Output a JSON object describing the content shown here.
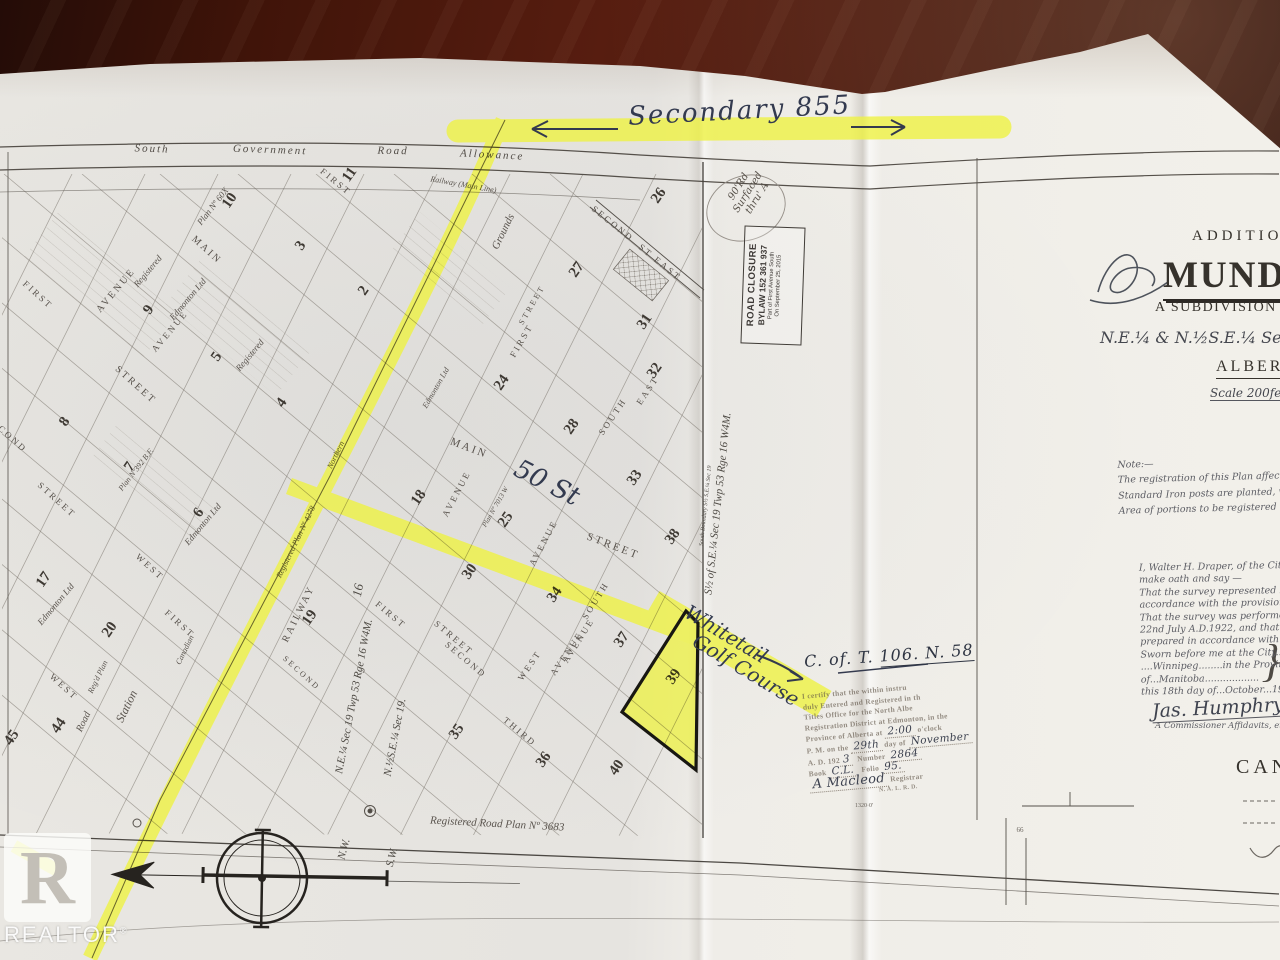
{
  "annotations": {
    "secondary": "Secondary  855",
    "fifty_st": "50 St",
    "whitetail_1": "Whitetail",
    "whitetail_2": "Golf Course",
    "cot_prefix": "C. of. T. ",
    "cot_number": "106. N. 58",
    "circle_note_1": "90'Rd",
    "circle_note_2": "Surfaced",
    "circle_note_3": "thru' A"
  },
  "title_block": {
    "addition": "ADDITION",
    "name": "MUNDA",
    "subdivision": "A SUBDIVISION OF PA",
    "legal": "N.E.¼ & N.½S.E.¼ Sec 19. Tw",
    "province": "ALBERTA",
    "scale": "Scale 200feet"
  },
  "note_block": {
    "heading": "Note:—",
    "lines": [
      "The registration of this Plan affects only th",
      "Standard Iron posts are planted, where sh",
      "Area of portions to be registered = 71·4"
    ]
  },
  "affidavit": {
    "lines": [
      "I, Walter H. Draper, of the City of Win",
      "make oath and say —",
      "That the survey represented by this p",
      "accordance with the provisions of the",
      "That the survey was performed bet",
      "22nd July A.D.1922, and that this pl",
      "prepared in accordance with the p",
      "Sworn before me at the City....of",
      "....Winnipeg........in the Province",
      "of...Manitoba..................",
      "this 18th day of...October...1922"
    ],
    "signature": "Jas. Humphry",
    "commissioner": "A Commissioner Affidavits, etc.",
    "canada": "CANAD"
  },
  "registry_stamp": {
    "l1": "I certify that the within instru",
    "l2": "duly Entered and Registered in th",
    "l3": "Titles Office for the North Albe",
    "l4": "Registration District at Edmonton, in the",
    "l5a": "Province of Alberta at",
    "time": "2:00",
    "l5b": "o'clock",
    "l6a": "P. M. on the",
    "day": "29th",
    "l6b": "day of",
    "month": "November",
    "l7a": "A. D. 192",
    "year": "3",
    "l7b": "Number",
    "number": "2864",
    "l8a": "Book",
    "book": "C.L.",
    "l8b": "Folio",
    "folio": "95.",
    "signature": "A Macleod",
    "registrar": "Registrar",
    "district": "N. A. L. R. D."
  },
  "road_closure": {
    "l1": "ROAD CLOSURE",
    "l2": "BYLAW  152 361 937",
    "l3": "Part of First Avenue South",
    "l4": "On September 25, 2015"
  },
  "watermark": {
    "letter": "R",
    "brand": "REALTOR",
    "reg": "®"
  },
  "map": {
    "labels": [
      {
        "t": "MAIN",
        "x": 205,
        "y": 252,
        "r": 42,
        "s": 10,
        "c": "st"
      },
      {
        "t": "AVENUE",
        "x": 118,
        "y": 292,
        "r": -50,
        "s": 10,
        "c": "st"
      },
      {
        "t": "AVENUE",
        "x": 172,
        "y": 333,
        "r": -50,
        "s": 9,
        "c": "st"
      },
      {
        "t": "FIRST",
        "x": 36,
        "y": 297,
        "r": 42,
        "s": 9,
        "c": "st"
      },
      {
        "t": "STREET",
        "x": 134,
        "y": 387,
        "r": 42,
        "s": 10,
        "c": "st"
      },
      {
        "t": "SECOND",
        "x": 5,
        "y": 436,
        "r": 42,
        "s": 9,
        "c": "st"
      },
      {
        "t": "STREET",
        "x": 55,
        "y": 502,
        "r": 42,
        "s": 9,
        "c": "st"
      },
      {
        "t": "WEST",
        "x": 148,
        "y": 569,
        "r": 42,
        "s": 9,
        "c": "st"
      },
      {
        "t": "FIRST",
        "x": 178,
        "y": 626,
        "r": 42,
        "s": 9,
        "c": "st"
      },
      {
        "t": "WEST",
        "x": 62,
        "y": 689,
        "r": 42,
        "s": 9,
        "c": "st"
      },
      {
        "t": "MAIN",
        "x": 468,
        "y": 451,
        "r": 21,
        "s": 11,
        "c": "st",
        "ls": 4
      },
      {
        "t": "STREET",
        "x": 612,
        "y": 549,
        "r": 21,
        "s": 11,
        "c": "st",
        "ls": 4
      },
      {
        "t": "FIRST",
        "x": 389,
        "y": 617,
        "r": 40,
        "s": 9,
        "c": "st"
      },
      {
        "t": "STREET",
        "x": 452,
        "y": 640,
        "r": 40,
        "s": 9,
        "c": "st"
      },
      {
        "t": "SECOND",
        "x": 464,
        "y": 662,
        "r": 40,
        "s": 9,
        "c": "st"
      },
      {
        "t": "THIRD",
        "x": 518,
        "y": 734,
        "r": 40,
        "s": 9,
        "c": "st"
      },
      {
        "t": "WEST",
        "x": 532,
        "y": 667,
        "r": -56,
        "s": 9,
        "c": "st"
      },
      {
        "t": "AVENUE",
        "x": 569,
        "y": 655,
        "r": -56,
        "s": 9,
        "c": "st"
      },
      {
        "t": "AVENUE",
        "x": 459,
        "y": 495,
        "r": -62,
        "s": 9,
        "c": "st"
      },
      {
        "t": "AVENUE",
        "x": 546,
        "y": 544,
        "r": -62,
        "s": 9,
        "c": "st"
      },
      {
        "t": "SOUTH",
        "x": 615,
        "y": 418,
        "r": -56,
        "s": 9,
        "c": "st"
      },
      {
        "t": "EAST",
        "x": 650,
        "y": 392,
        "r": -56,
        "s": 9,
        "c": "st"
      },
      {
        "t": "FIRST",
        "x": 524,
        "y": 342,
        "r": -60,
        "s": 9,
        "c": "st"
      },
      {
        "t": "STREET",
        "x": 534,
        "y": 306,
        "r": -60,
        "s": 8,
        "c": "st"
      },
      {
        "t": "SECOND",
        "x": 611,
        "y": 226,
        "r": 39,
        "s": 9,
        "c": "st"
      },
      {
        "t": "ST",
        "x": 644,
        "y": 253,
        "r": 39,
        "s": 9,
        "c": "st"
      },
      {
        "t": "EAST",
        "x": 666,
        "y": 271,
        "r": 39,
        "s": 9,
        "c": "st"
      },
      {
        "t": "FIRST",
        "x": 334,
        "y": 184,
        "r": 39,
        "s": 9,
        "c": "st"
      },
      {
        "t": "SOUTH",
        "x": 598,
        "y": 602,
        "r": -58,
        "s": 9,
        "c": "st"
      },
      {
        "t": "AVENUE",
        "x": 581,
        "y": 642,
        "r": -58,
        "s": 9,
        "c": "st"
      },
      {
        "t": "SECOND",
        "x": 300,
        "y": 675,
        "r": 42,
        "s": 8,
        "c": "st"
      },
      {
        "t": "RAILWAY",
        "x": 301,
        "y": 615,
        "r": -64,
        "s": 10,
        "c": "st",
        "ls": 4
      },
      {
        "t": "Station",
        "x": 130,
        "y": 708,
        "r": -64,
        "s": 12,
        "c": "cur"
      },
      {
        "t": "Grounds",
        "x": 506,
        "y": 233,
        "r": -64,
        "s": 11,
        "c": "cur"
      },
      {
        "t": "Road",
        "x": 86,
        "y": 723,
        "r": -64,
        "s": 10,
        "c": "cur"
      },
      {
        "t": "Canadian",
        "x": 187,
        "y": 651,
        "r": -64,
        "s": 8,
        "c": "cur"
      },
      {
        "t": "Northern",
        "x": 338,
        "y": 456,
        "r": -64,
        "s": 8,
        "c": "cur"
      },
      {
        "t": "Railway  (Main Line)",
        "x": 463,
        "y": 187,
        "r": 10,
        "s": 8,
        "c": "cur"
      },
      {
        "t": "Edmonton Ltd",
        "x": 190,
        "y": 301,
        "r": -50,
        "s": 9,
        "c": "cur"
      },
      {
        "t": "Edmonton Ltd",
        "x": 205,
        "y": 526,
        "r": -50,
        "s": 9,
        "c": "cur"
      },
      {
        "t": "Edmonton Ltd",
        "x": 58,
        "y": 606,
        "r": -50,
        "s": 9,
        "c": "cur"
      },
      {
        "t": "Edmonton Ltd",
        "x": 438,
        "y": 389,
        "r": -60,
        "s": 8,
        "c": "cur"
      },
      {
        "t": "Registered",
        "x": 150,
        "y": 273,
        "r": -50,
        "s": 9,
        "c": "cur"
      },
      {
        "t": "Registered",
        "x": 252,
        "y": 357,
        "r": -50,
        "s": 9,
        "c": "cur"
      },
      {
        "t": "Reg'd Plan",
        "x": 100,
        "y": 678,
        "r": -64,
        "s": 8,
        "c": "cur"
      },
      {
        "t": "Plan Nº 60X",
        "x": 215,
        "y": 208,
        "r": -52,
        "s": 9,
        "c": "cur"
      },
      {
        "t": "Plan Nº392 B.F.",
        "x": 138,
        "y": 471,
        "r": -52,
        "s": 8,
        "c": "cur"
      },
      {
        "t": "Registered Plan Nº 4278",
        "x": 298,
        "y": 543,
        "r": -64,
        "s": 8,
        "c": "cur"
      },
      {
        "t": "Plan Nº 7013 W",
        "x": 497,
        "y": 508,
        "r": -60,
        "s": 7,
        "c": "cur"
      },
      {
        "t": "N.E.¼ Sec 19 Twp 53 Rge 16 W4M.",
        "x": 357,
        "y": 697,
        "r": -79,
        "s": 11,
        "c": "leg"
      },
      {
        "t": "N.½S.E.¼ Sec 19.",
        "x": 398,
        "y": 738,
        "r": -79,
        "s": 11,
        "c": "leg"
      },
      {
        "t": "16",
        "x": 362,
        "y": 591,
        "r": -79,
        "s": 13,
        "c": "leg"
      },
      {
        "t": "S½ of S.E.¼ Sec 19 Twp 53 Rge 16 W4M.",
        "x": 721,
        "y": 504,
        "r": -84,
        "s": 11,
        "c": "leg"
      },
      {
        "t": "South Boundary S½ S.E.¼ Sec 19",
        "x": 707,
        "y": 506,
        "r": -84,
        "s": 6,
        "c": "leg"
      },
      {
        "t": "N.W.",
        "x": 347,
        "y": 850,
        "r": -75,
        "s": 11,
        "c": "leg"
      },
      {
        "t": "S.W.",
        "x": 395,
        "y": 858,
        "r": -75,
        "s": 11,
        "c": "leg"
      },
      {
        "t": "South",
        "x": 152,
        "y": 152,
        "r": 2,
        "s": 11,
        "c": "top"
      },
      {
        "t": "Government",
        "x": 270,
        "y": 153,
        "r": 2,
        "s": 11,
        "c": "top"
      },
      {
        "t": "Road",
        "x": 393,
        "y": 154,
        "r": 1,
        "s": 11,
        "c": "top"
      },
      {
        "t": "Allowance",
        "x": 492,
        "y": 158,
        "r": 3,
        "s": 11,
        "c": "top"
      },
      {
        "t": "Registered  Road  Plan  Nº 3683",
        "x": 497,
        "y": 827,
        "r": 3,
        "s": 11,
        "c": "cur"
      },
      {
        "t": "66",
        "x": 1020,
        "y": 832,
        "r": 0,
        "s": 7,
        "c": "dim"
      },
      {
        "t": "1320·0'",
        "x": 864,
        "y": 807,
        "r": 0,
        "s": 6,
        "c": "dim"
      },
      {
        "t": "}",
        "x": 1271,
        "y": 676,
        "r": 0,
        "s": 46,
        "c": "leg"
      }
    ],
    "lots": [
      {
        "t": "11",
        "x": 353,
        "y": 177
      },
      {
        "t": "10",
        "x": 233,
        "y": 203
      },
      {
        "t": "26",
        "x": 662,
        "y": 198
      },
      {
        "t": "27",
        "x": 580,
        "y": 272
      },
      {
        "t": "3",
        "x": 304,
        "y": 248
      },
      {
        "t": "2",
        "x": 367,
        "y": 293
      },
      {
        "t": "9",
        "x": 152,
        "y": 312
      },
      {
        "t": "5",
        "x": 220,
        "y": 359
      },
      {
        "t": "4",
        "x": 285,
        "y": 405
      },
      {
        "t": "8",
        "x": 68,
        "y": 424
      },
      {
        "t": "7",
        "x": 133,
        "y": 469
      },
      {
        "t": "6",
        "x": 202,
        "y": 515
      },
      {
        "t": "17",
        "x": 47,
        "y": 582
      },
      {
        "t": "20",
        "x": 113,
        "y": 632
      },
      {
        "t": "18",
        "x": 422,
        "y": 500
      },
      {
        "t": "24",
        "x": 505,
        "y": 385
      },
      {
        "t": "25",
        "x": 509,
        "y": 522
      },
      {
        "t": "28",
        "x": 575,
        "y": 429
      },
      {
        "t": "30",
        "x": 473,
        "y": 574
      },
      {
        "t": "31",
        "x": 648,
        "y": 324
      },
      {
        "t": "32",
        "x": 658,
        "y": 373
      },
      {
        "t": "33",
        "x": 638,
        "y": 480
      },
      {
        "t": "34",
        "x": 558,
        "y": 597
      },
      {
        "t": "35",
        "x": 460,
        "y": 734
      },
      {
        "t": "36",
        "x": 547,
        "y": 762
      },
      {
        "t": "37",
        "x": 625,
        "y": 642
      },
      {
        "t": "38",
        "x": 676,
        "y": 539
      },
      {
        "t": "39",
        "x": 677,
        "y": 679
      },
      {
        "t": "40",
        "x": 620,
        "y": 770
      },
      {
        "t": "44",
        "x": 62,
        "y": 728
      },
      {
        "t": "45",
        "x": 15,
        "y": 740
      },
      {
        "t": "19",
        "x": 313,
        "y": 620
      }
    ]
  }
}
